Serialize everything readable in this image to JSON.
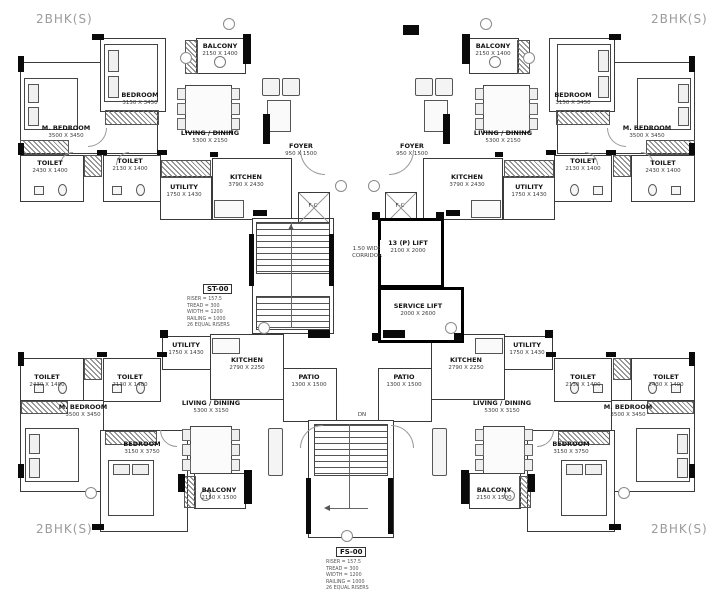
{
  "corner_labels": {
    "top_left": "2BHK(S)",
    "top_right": "2BHK(S)",
    "bottom_left": "2BHK(S)",
    "bottom_right": "2BHK(S)"
  },
  "units": {
    "top_left": {
      "m_bedroom": {
        "name": "M. BEDROOM",
        "dims": "3500 X 3450"
      },
      "bedroom": {
        "name": "BEDROOM",
        "dims": "3150 X 3450"
      },
      "living_dining": {
        "name": "LIVING / DINING",
        "dims": "5300 X 2150"
      },
      "kitchen": {
        "name": "KITCHEN",
        "dims": "3790 X 2430"
      },
      "utility": {
        "name": "UTILITY",
        "dims": "1750 X 1430"
      },
      "toilet_1": {
        "name": "TOILET",
        "dims": "2430 X 1400"
      },
      "toilet_2": {
        "name": "TOILET",
        "dims": "2130 X 1400"
      },
      "balcony": {
        "name": "BALCONY",
        "dims": "2150 X 1400"
      },
      "foyer": {
        "name": "FOYER",
        "dims": "950 X 1500"
      }
    },
    "top_right": {
      "m_bedroom": {
        "name": "M. BEDROOM",
        "dims": "3500 X 3450"
      },
      "bedroom": {
        "name": "BEDROOM",
        "dims": "3150 X 3450"
      },
      "living_dining": {
        "name": "LIVING / DINING",
        "dims": "5300 X 2150"
      },
      "kitchen": {
        "name": "KITCHEN",
        "dims": "3790 X 2430"
      },
      "utility": {
        "name": "UTILITY",
        "dims": "1750 X 1430"
      },
      "toilet_1": {
        "name": "TOILET",
        "dims": "2430 X 1400"
      },
      "toilet_2": {
        "name": "TOILET",
        "dims": "2130 X 1400"
      },
      "balcony": {
        "name": "BALCONY",
        "dims": "2150 X 1400"
      },
      "foyer": {
        "name": "FOYER",
        "dims": "950 X 1500"
      }
    },
    "bottom_left": {
      "m_bedroom": {
        "name": "M. BEDROOM",
        "dims": "3500 X 3450"
      },
      "bedroom": {
        "name": "BEDROOM",
        "dims": "3150 X 3750"
      },
      "living_dining": {
        "name": "LIVING / DINING",
        "dims": "5300 X 3150"
      },
      "kitchen": {
        "name": "KITCHEN",
        "dims": "2790 X 2250"
      },
      "utility": {
        "name": "UTILITY",
        "dims": "1750 X 1430"
      },
      "toilet_1": {
        "name": "TOILET",
        "dims": "2430 X 1400"
      },
      "toilet_2": {
        "name": "TOILET",
        "dims": "2130 X 1400"
      },
      "balcony": {
        "name": "BALCONY",
        "dims": "2150 X 1500"
      },
      "patio": {
        "name": "PATIO",
        "dims": "1300 X 1500"
      }
    },
    "bottom_right": {
      "m_bedroom": {
        "name": "M. BEDROOM",
        "dims": "3500 X 3450"
      },
      "bedroom": {
        "name": "BEDROOM",
        "dims": "3150 X 3750"
      },
      "living_dining": {
        "name": "LIVING / DINING",
        "dims": "5300 X 3150"
      },
      "kitchen": {
        "name": "KITCHEN",
        "dims": "2790 X 2250"
      },
      "utility": {
        "name": "UTILITY",
        "dims": "1750 X 1430"
      },
      "toilet_1": {
        "name": "TOILET",
        "dims": "2430 X 1400"
      },
      "toilet_2": {
        "name": "TOILET",
        "dims": "2130 X 1400"
      },
      "balcony": {
        "name": "BALCONY",
        "dims": "2150 X 1500"
      },
      "patio": {
        "name": "PATIO",
        "dims": "1300 X 1500"
      }
    }
  },
  "core": {
    "passenger_lift": {
      "name": "13 (P) LIFT",
      "dims": "2100 X 2000"
    },
    "service_lift": {
      "name": "SERVICE LIFT",
      "dims": "2000 X 2600"
    },
    "corridor": {
      "line1": "1.50 WIDE",
      "line2": "CORRIDOR"
    },
    "shaft_label": "F-C",
    "down_label": "DN",
    "stair_st": {
      "code": "ST-00",
      "specs": [
        "RISER = 157.5",
        "TREAD = 300",
        "WIDTH = 1200",
        "RAILING = 1000",
        "26 EQUAL RISERS"
      ]
    },
    "stair_fs": {
      "code": "FS-00",
      "specs": [
        "RISER = 157.5",
        "TREAD = 300",
        "WIDTH = 1200",
        "RAILING = 1000",
        "26 EQUAL RISERS"
      ]
    }
  }
}
